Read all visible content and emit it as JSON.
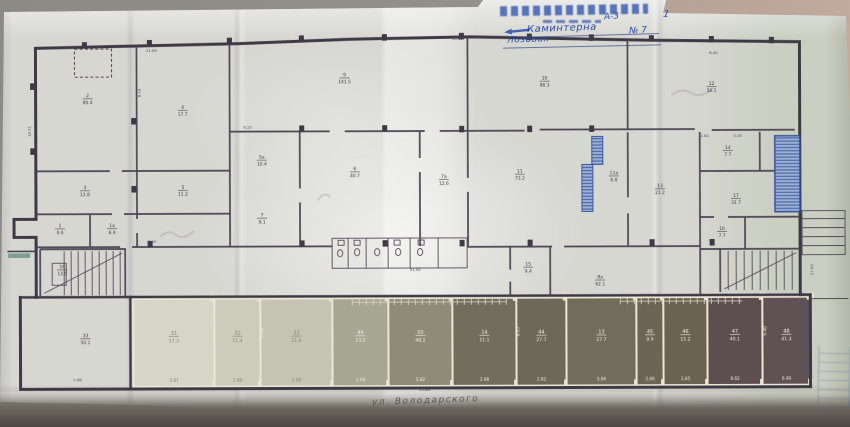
{
  "scene": {
    "street_label": "ул. Володарского"
  },
  "stamp": {
    "code": "А-3",
    "line1_handwritten": "Каминтерна",
    "line2_handwritten": "Лозовая",
    "number": "№ 7",
    "mark": "1"
  },
  "colors": {
    "ink": "#3e3a46",
    "ink_inner": "#4e4454",
    "paper": "#d7d7d2",
    "stamp_blue": "#2b4da8",
    "hatch_blue_fill": "#9db1d6",
    "hatch_blue_line": "#2d4fa0",
    "wall_light": "#ece7d4"
  },
  "plan": {
    "room_labels": [
      {
        "x": 88,
        "y": 96,
        "num": "2",
        "area": "89.4"
      },
      {
        "x": 183,
        "y": 108,
        "num": "4",
        "area": "17.7"
      },
      {
        "x": 85,
        "y": 188,
        "num": "3",
        "area": "12.8"
      },
      {
        "x": 183,
        "y": 188,
        "num": "5",
        "area": "11.2"
      },
      {
        "x": 60,
        "y": 226,
        "num": "1",
        "area": "9.6"
      },
      {
        "x": 112,
        "y": 226,
        "num": "1а",
        "area": "8.9"
      },
      {
        "x": 345,
        "y": 76,
        "num": "9",
        "area": "141.5"
      },
      {
        "x": 545,
        "y": 80,
        "num": "10",
        "area": "98.3"
      },
      {
        "x": 712,
        "y": 86,
        "num": "12",
        "area": "56.1"
      },
      {
        "x": 262,
        "y": 158,
        "num": "5а",
        "area": "10.4"
      },
      {
        "x": 262,
        "y": 216,
        "num": "7",
        "area": "9.1"
      },
      {
        "x": 355,
        "y": 170,
        "num": "6",
        "area": "40.7"
      },
      {
        "x": 444,
        "y": 178,
        "num": "7а",
        "area": "12.6"
      },
      {
        "x": 520,
        "y": 173,
        "num": "11",
        "area": "73.2"
      },
      {
        "x": 614,
        "y": 175,
        "num": "11а",
        "area": "6.8"
      },
      {
        "x": 660,
        "y": 188,
        "num": "13",
        "area": "21.2"
      },
      {
        "x": 728,
        "y": 150,
        "num": "14",
        "area": "7.7"
      },
      {
        "x": 736,
        "y": 198,
        "num": "17",
        "area": "31.7"
      },
      {
        "x": 722,
        "y": 231,
        "num": "16",
        "area": "7.7"
      },
      {
        "x": 62,
        "y": 267,
        "num": "1б",
        "area": "13.5"
      },
      {
        "x": 528,
        "y": 266,
        "num": "15",
        "area": "9.4"
      },
      {
        "x": 600,
        "y": 279,
        "num": "8а",
        "area": "62.1"
      },
      {
        "x": 85,
        "y": 336,
        "num": "33",
        "area": "50.1"
      }
    ],
    "dimensions": [
      {
        "x": 152,
        "y": 51,
        "t": "21.69"
      },
      {
        "x": 458,
        "y": 40,
        "t": "55.89"
      },
      {
        "x": 714,
        "y": 55,
        "t": "6.40"
      },
      {
        "x": 705,
        "y": 138,
        "t": "1.82"
      },
      {
        "x": 738,
        "y": 138,
        "t": "4.05"
      },
      {
        "x": 415,
        "y": 271,
        "t": "51.00"
      },
      {
        "x": 424,
        "y": 391,
        "t": "35.80"
      },
      {
        "x": 152,
        "y": 242,
        "t": "2.90"
      },
      {
        "x": 248,
        "y": 128,
        "t": "6.25"
      },
      {
        "x": 77,
        "y": 380,
        "t": "5.98"
      },
      {
        "x": 31,
        "y": 130,
        "t": "16.51",
        "rot": -90
      },
      {
        "x": 141,
        "y": 92,
        "t": "8.19",
        "rot": -90
      },
      {
        "x": 813,
        "y": 271,
        "t": "27.60",
        "rot": -90
      }
    ],
    "columns": [
      [
        85,
        44
      ],
      [
        150,
        42
      ],
      [
        230,
        40
      ],
      [
        302,
        38
      ],
      [
        385,
        37
      ],
      [
        462,
        36
      ],
      [
        530,
        37
      ],
      [
        592,
        38
      ],
      [
        652,
        39
      ],
      [
        712,
        40
      ],
      [
        772,
        41
      ],
      [
        302,
        128
      ],
      [
        385,
        128
      ],
      [
        462,
        129
      ],
      [
        530,
        129
      ],
      [
        592,
        129
      ],
      [
        150,
        243
      ],
      [
        302,
        243
      ],
      [
        385,
        243
      ],
      [
        462,
        243
      ],
      [
        530,
        243
      ],
      [
        652,
        243
      ],
      [
        712,
        243
      ],
      [
        33,
        85
      ],
      [
        33,
        150
      ],
      [
        134,
        120
      ],
      [
        134,
        188
      ]
    ],
    "garage_band": {
      "top": 298,
      "bottom": 386,
      "rooms": [
        {
          "x1": 133,
          "x2": 214,
          "fill": "#d5d5c7",
          "ink": "#84846f",
          "num": "31",
          "area": "17.3",
          "dim": "5.87"
        },
        {
          "x1": 214,
          "x2": 260,
          "fill": "#cccbbb",
          "ink": "#84846f",
          "num": "32",
          "area": "11.4",
          "dim": "2.89"
        },
        {
          "x1": 260,
          "x2": 332,
          "fill": "#c5c4b2",
          "ink": "#84846f",
          "num": "33",
          "area": "21.6",
          "dim": "5.89"
        },
        {
          "x1": 332,
          "x2": 388,
          "fill": "#a7a691",
          "ink": "#f2efe2",
          "num": "49",
          "area": "23.2",
          "dim": "2.69"
        },
        {
          "x1": 388,
          "x2": 452,
          "fill": "#8f8b77",
          "ink": "#f2efe2",
          "num": "50",
          "area": "48.2",
          "dim": "5.82"
        },
        {
          "x1": 452,
          "x2": 516,
          "fill": "#726e5c",
          "ink": "#f2efe2",
          "num": "14",
          "area": "11.1",
          "dim": "2.68"
        },
        {
          "x1": 516,
          "x2": 566,
          "fill": "#6c6958",
          "ink": "#f2efe2",
          "num": "44",
          "area": "27.7",
          "dim": "2.62"
        },
        {
          "x1": 566,
          "x2": 636,
          "fill": "#716d5b",
          "ink": "#f2efe2",
          "num": "13",
          "area": "27.7",
          "dim": "5.60"
        },
        {
          "x1": 636,
          "x2": 663,
          "fill": "#6c6453",
          "ink": "#f2efe2",
          "num": "45",
          "area": "9.9",
          "dim": "2.60"
        },
        {
          "x1": 663,
          "x2": 707,
          "fill": "#6b6251",
          "ink": "#f2efe2",
          "num": "46",
          "area": "15.2",
          "dim": "2.65"
        },
        {
          "x1": 707,
          "x2": 762,
          "fill": "#5e4e50",
          "ink": "#f2efe2",
          "num": "47",
          "area": "40.1",
          "dim": "8.62"
        },
        {
          "x1": 762,
          "x2": 810,
          "fill": "#615254",
          "ink": "#f2efe2",
          "num": "48",
          "area": "41.3",
          "dim": "6.40"
        }
      ],
      "side_dims": [
        {
          "x": 263,
          "y": 332,
          "t": "6.98"
        },
        {
          "x": 519,
          "y": 332,
          "t": "8.65"
        },
        {
          "x": 766,
          "y": 332,
          "t": "6.40"
        }
      ],
      "tick_chains": [
        {
          "x1": 352,
          "x2": 506,
          "y": 302
        },
        {
          "x1": 620,
          "x2": 742,
          "y": 302
        }
      ]
    }
  }
}
